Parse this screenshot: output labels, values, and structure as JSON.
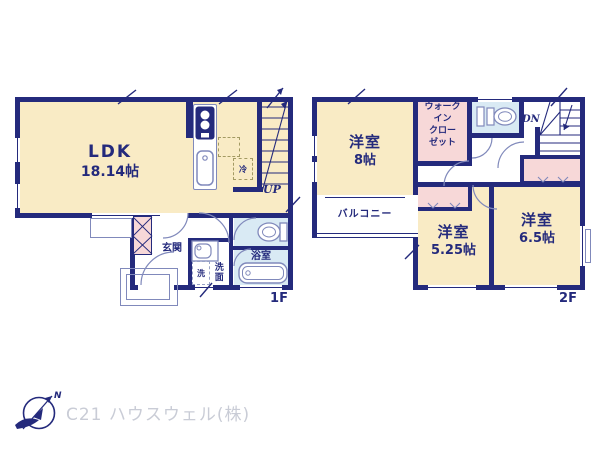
{
  "plan": {
    "floor1": {
      "label": "1F",
      "ldk": {
        "name": "LDK",
        "size": "18.14帖"
      },
      "entrance": "玄関",
      "washroom": "洗面",
      "bathroom": "浴室",
      "fridge": "冷",
      "washer": "洗",
      "stairs": "UP"
    },
    "floor2": {
      "label": "2F",
      "bedroom_8": {
        "name": "洋室",
        "size": "8帖"
      },
      "wic_lines": [
        "ウォーク",
        "イン",
        "クロー",
        "ゼット"
      ],
      "balcony": "バルコニー",
      "bedroom_525": {
        "name": "洋室",
        "size": "5.25帖"
      },
      "bedroom_65": {
        "name": "洋室",
        "size": "6.5帖"
      },
      "stairs": "DN"
    }
  },
  "footer": {
    "company": "C21 ハウスウェル(株)",
    "compass_north": "N"
  },
  "colors": {
    "wall": "#242a7c",
    "room_cream": "#f9ebc5",
    "closet_pink": "#f7d8d8",
    "wet_area_blue": "#d9eaf4",
    "fixture_line": "#8089bb",
    "company_text": "#c9ccd6"
  }
}
